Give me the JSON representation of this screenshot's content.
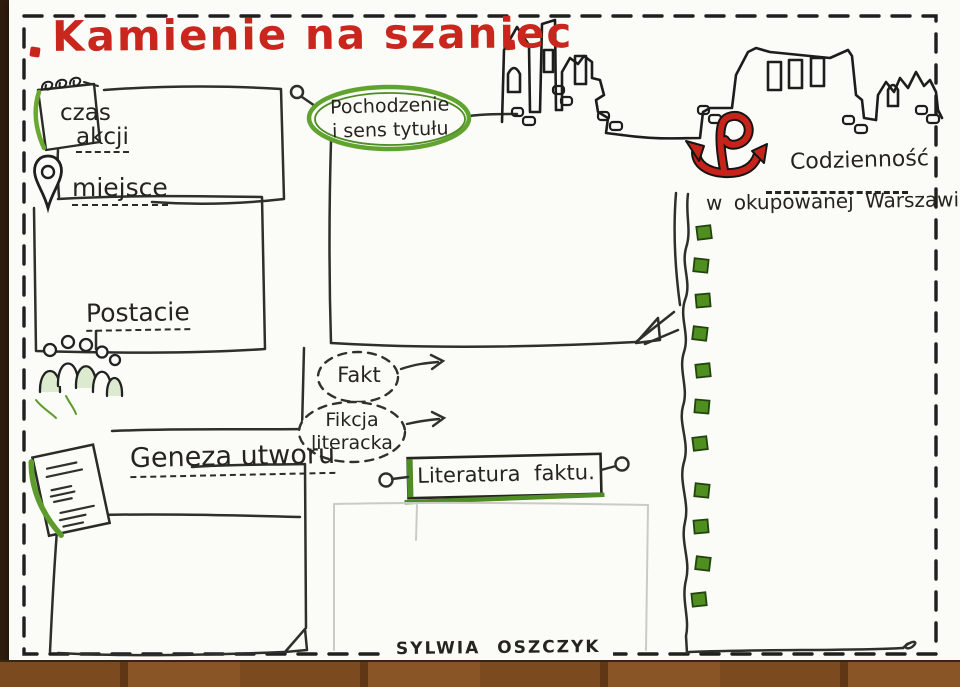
{
  "title": {
    "text": "Kamienie na szaniec"
  },
  "labels": {
    "czas": {
      "line1": "czas",
      "line2": "akcji"
    },
    "miejsce": "miejsce",
    "postacie": "Postacie",
    "geneza": "Geneza utworu",
    "pochodzenie": {
      "line1": "Pochodzenie",
      "line2": "i sens tytułu"
    },
    "fakt": "Fakt",
    "fikcja": {
      "line1": "Fikcja",
      "line2": "literacka"
    },
    "literatura": "Literatura faktu.",
    "codziennosc": {
      "line1": "Codzienność",
      "line2": "w okupowanej Warszawie"
    }
  },
  "signature": {
    "text": "SYLWIA OSZCZYK"
  },
  "icons": {
    "notepad": "notepad-spiral-icon",
    "pin": "location-pin-icon",
    "people": "people-group-icon",
    "document": "document-icon",
    "anchor": "kotwica-anchor-icon",
    "skyline": "warsaw-ruins-skyline",
    "checkboxes": "green-checkbox-column",
    "checkbox_count": 11
  },
  "colors": {
    "title_red": "#c9261d",
    "accent_green": "#5d9c2c",
    "checkbox_green": "#4e8f1f",
    "ink": "#26241f",
    "paper": "#fbfbf8",
    "wood_brown": "#7b4a1e"
  }
}
